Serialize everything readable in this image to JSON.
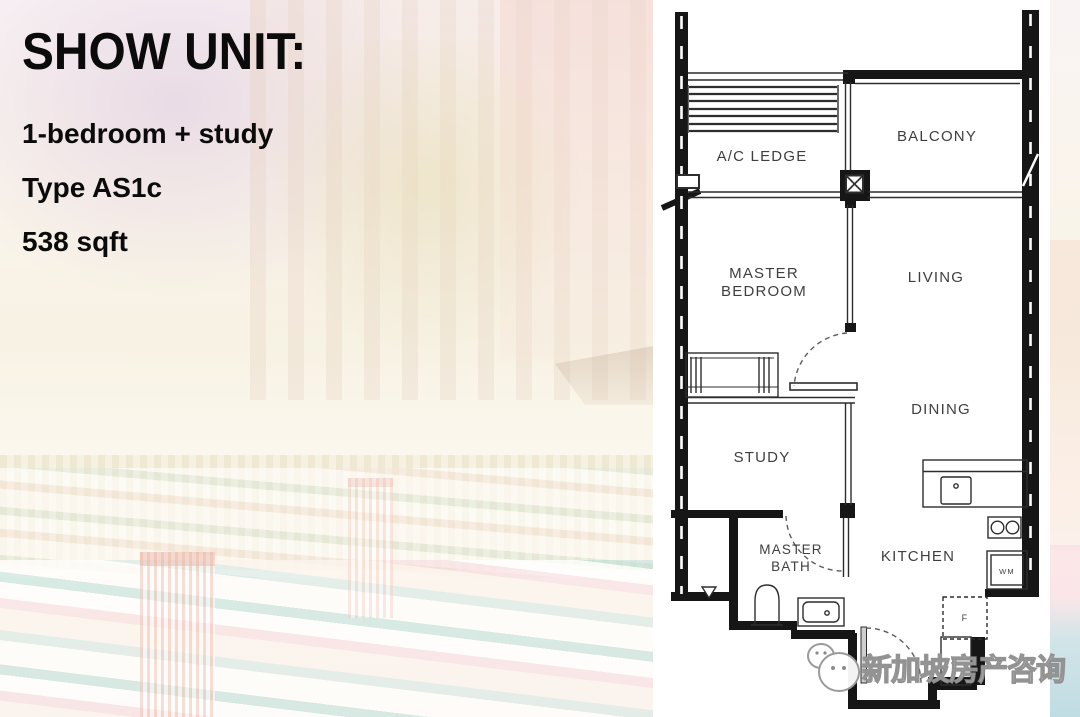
{
  "info_panel": {
    "title": "SHOW UNIT:",
    "line1": "1-bedroom + study",
    "line2": "Type AS1c",
    "line3": "538 sqft"
  },
  "floor_plan": {
    "labels": {
      "ac_ledge": "A/C LEDGE",
      "balcony": "BALCONY",
      "master_bedroom_line1": "MASTER",
      "master_bedroom_line2": "BEDROOM",
      "living": "LIVING",
      "dining": "DINING",
      "study": "STUDY",
      "master_bath_line1": "MASTER",
      "master_bath_line2": "BATH",
      "kitchen": "KITCHEN",
      "washing_machine": "WM",
      "fridge": "F",
      "store": "ST"
    }
  },
  "watermark": {
    "text": "新加坡房产咨询",
    "icon": "wechat-icon"
  },
  "colors": {
    "wall": "#161616",
    "thin_line": "#2d2d2d",
    "label_text": "#3f3f3f",
    "panel_bg": "#ffffff",
    "info_text": "#0b0b0b"
  }
}
